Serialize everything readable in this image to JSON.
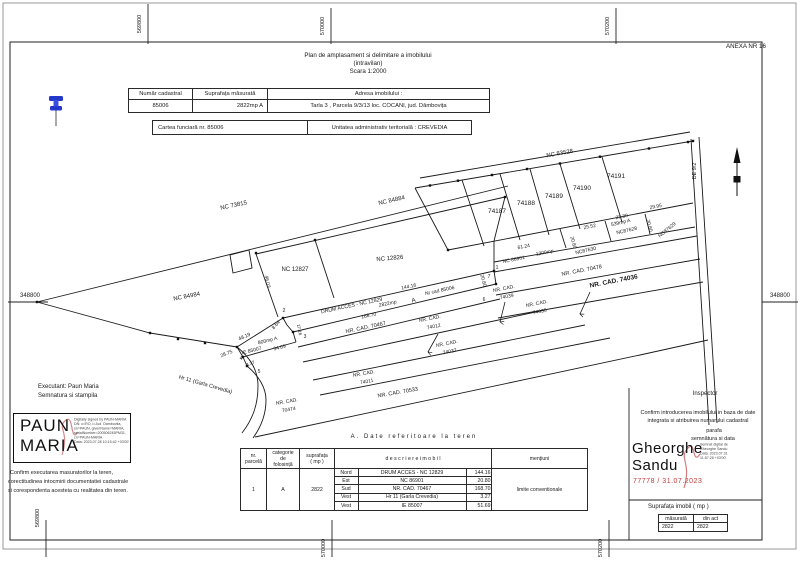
{
  "anexa": "ANEXA NR 16",
  "title": {
    "line1": "Plan de amplasament si delimitare a imobilului",
    "line2": "(intravilan)",
    "line3": "Scara 1:2000"
  },
  "id_table": {
    "h1": "Număr cadastral",
    "h2": "Suprafața măsurată",
    "h3": "Adresa imobilului :",
    "v1": "85006",
    "v2": "2822mp A",
    "v3": "Tarla 3 , Parcela 9/3/13 loc. COCANI, jud. Dâmbovița"
  },
  "cf_row": {
    "left": "Cartea funciară  nr.  85006",
    "right": "Unitatea administrativ teritorială :    CREVEDIA"
  },
  "terrain_table": {
    "title": "A. Date referitoare la teren",
    "headers": {
      "nr_l1": "nr.",
      "nr_l2": "parcelă",
      "cat_l1": "categorie",
      "cat_l2": "de",
      "cat_l3": "folosință",
      "sup_l1": "suprafața",
      "sup_l2": "( mp )",
      "desc": "d e s c r i e r e   i m o b i l",
      "ment": "mențiuni"
    },
    "row": {
      "nr": "1",
      "cat": "A",
      "sup": "2822",
      "ment": "limite conventionale"
    },
    "sides": [
      {
        "dir": "Nord",
        "desc": "DRUM ACCES - NC 12829",
        "len": "144.16"
      },
      {
        "dir": "Est",
        "desc": "NC 86901",
        "len": "20.80"
      },
      {
        "dir": "Sud",
        "desc": "NR. CAD. 70467",
        "len": "168.70"
      },
      {
        "dir": "Vest",
        "desc": "Hr 11 (Garla Crevedia)",
        "len": "3.27"
      },
      {
        "dir": "Vest",
        "desc": "IE 85007",
        "len": "51.69"
      }
    ]
  },
  "executant": {
    "line1": "Executant: Paun Maria",
    "line2": "Semnatura si stampila",
    "stamp_l1": "PAUN",
    "stamp_l2": "MARIA",
    "digital": [
      "Digitally signed by PAUN-MARIA",
      "DN: c=RO, l=Jud. Dambovita,",
      "sn=PAUN, givenName=MARIA,",
      "serialNumber=200506245PM31,",
      "cn=PAUN-MARIA",
      "Data: 2023.07.28 10:15:42 +03'00'"
    ],
    "confirm1": "Confirm executarea masuratorilor la teren,",
    "confirm2": "corectitudinea intocmirii documentatiei cadastrale",
    "confirm3": "si corespondenta acesteia cu realitatea din teren."
  },
  "inspector": {
    "title": "Inspector",
    "confirm1": "Confirm introducerea imobilului in baza de date",
    "confirm2": "integrata si atribuirea numarului cadastral",
    "parafa": "parafa",
    "semnatura": "semnătura si data",
    "name_l1": "Gheorghe",
    "name_l2": "Sandu",
    "digital": [
      "Semnat digital de",
      "Gheorghe Sandu",
      "Data: 2023.07.31",
      "11:57:28 +03'00'"
    ],
    "stamp_red": "77778 / 31.07.2023",
    "red_color": "#c43b3b"
  },
  "area_table": {
    "title": "Suprafața imobil ( mp )",
    "col1": "măsurată",
    "col2": "din act",
    "val1": "2822",
    "val2": "2822"
  },
  "plan": {
    "accent_blue": "#2438cc",
    "labels": [
      {
        "name": "coord-top-569800",
        "text": "569800",
        "x": 141,
        "y": 24,
        "r": -90,
        "s": 5.5
      },
      {
        "name": "coord-top-570000",
        "text": "570000",
        "x": 324,
        "y": 26,
        "r": -90,
        "s": 5.5
      },
      {
        "name": "coord-top-570200",
        "text": "570200",
        "x": 609,
        "y": 26,
        "r": -90,
        "s": 5.5
      },
      {
        "name": "coord-bottom-569800",
        "text": "569800",
        "x": 39,
        "y": 518,
        "r": -90,
        "s": 5.5
      },
      {
        "name": "coord-bottom-570000",
        "text": "570000",
        "x": 325,
        "y": 548,
        "r": -90,
        "s": 5.5
      },
      {
        "name": "coord-bottom-570200",
        "text": "570200",
        "x": 602,
        "y": 548,
        "r": -90,
        "s": 5.5
      },
      {
        "name": "coord-left-348800",
        "text": "348800",
        "x": 30,
        "y": 297,
        "r": 0,
        "s": 6
      },
      {
        "name": "coord-right-348800",
        "text": "348800",
        "x": 780,
        "y": 297,
        "r": 0,
        "s": 6
      },
      {
        "name": "label-nc-73815",
        "text": "NC 73815",
        "x": 234,
        "y": 207,
        "r": -12,
        "s": 6
      },
      {
        "name": "label-nc-84884",
        "text": "NC 84884",
        "x": 392,
        "y": 202,
        "r": -13,
        "s": 6
      },
      {
        "name": "label-nc-84984",
        "text": "NC 84984",
        "x": 187,
        "y": 298,
        "r": -11,
        "s": 6
      },
      {
        "name": "label-nc-12827",
        "text": "NC 12827",
        "x": 295,
        "y": 271,
        "r": 0,
        "s": 6
      },
      {
        "name": "label-nc-12826",
        "text": "NC 12826",
        "x": 390,
        "y": 260,
        "r": -5,
        "s": 6
      },
      {
        "name": "meas-46-03",
        "text": "46.03",
        "x": 266,
        "y": 282,
        "r": 78,
        "s": 5
      },
      {
        "name": "label-nc-83528",
        "text": "NC 83528",
        "x": 560,
        "y": 155,
        "r": -10,
        "s": 6
      },
      {
        "name": "parcel-74187",
        "text": "74187",
        "x": 497,
        "y": 213,
        "r": 0,
        "s": 6.5
      },
      {
        "name": "parcel-74188",
        "text": "74188",
        "x": 526,
        "y": 205,
        "r": 0,
        "s": 6.5
      },
      {
        "name": "parcel-74189",
        "text": "74189",
        "x": 554,
        "y": 198,
        "r": 0,
        "s": 6.5
      },
      {
        "name": "parcel-74190",
        "text": "74190",
        "x": 582,
        "y": 190,
        "r": 0,
        "s": 6.5
      },
      {
        "name": "parcel-74191",
        "text": "74191",
        "x": 616,
        "y": 178,
        "r": 0,
        "s": 6.5
      },
      {
        "name": "label-de-9-2",
        "text": "DE 9/2",
        "x": 696,
        "y": 171,
        "r": -90,
        "s": 5.5
      },
      {
        "name": "meas-25-52",
        "text": "25.52",
        "x": 590,
        "y": 228,
        "r": -11,
        "s": 5
      },
      {
        "name": "meas-27-30",
        "text": "27.30",
        "x": 622,
        "y": 218,
        "r": -11,
        "s": 5
      },
      {
        "name": "meas-29-95",
        "text": "29.95",
        "x": 656,
        "y": 208,
        "r": -11,
        "s": 5
      },
      {
        "name": "label-539mp-a",
        "text": "539mp A",
        "x": 621,
        "y": 224,
        "r": -13,
        "s": 5
      },
      {
        "name": "label-nc87628",
        "text": "NC87628",
        "x": 627,
        "y": 232,
        "r": -13,
        "s": 5
      },
      {
        "name": "label-nc87630",
        "text": "NC87630",
        "x": 586,
        "y": 252,
        "r": -13,
        "s": 5
      },
      {
        "name": "label-nc87629",
        "text": "NC87629",
        "x": 668,
        "y": 231,
        "r": -40,
        "s": 5
      },
      {
        "name": "meas-20-80-a",
        "text": "20.80",
        "x": 572,
        "y": 243,
        "r": 75,
        "s": 5
      },
      {
        "name": "meas-20-80-b",
        "text": "20.80",
        "x": 648,
        "y": 226,
        "r": 75,
        "s": 5
      },
      {
        "name": "meas-20-80-c",
        "text": "20.80",
        "x": 482,
        "y": 281,
        "r": 75,
        "s": 5
      },
      {
        "name": "meas-61-24",
        "text": "61.24",
        "x": 524,
        "y": 248,
        "r": -11,
        "s": 5
      },
      {
        "name": "label-nc-86901",
        "text": "NC 86901",
        "x": 514,
        "y": 261,
        "r": -11,
        "s": 5
      },
      {
        "name": "label-1200mp",
        "text": "1200mp",
        "x": 545,
        "y": 254,
        "r": -11,
        "s": 5
      },
      {
        "name": "point-1",
        "text": "1",
        "x": 497,
        "y": 269,
        "r": 0,
        "s": 5
      },
      {
        "name": "point-7",
        "text": "7",
        "x": 489,
        "y": 278,
        "r": 0,
        "s": 5
      },
      {
        "name": "point-6",
        "text": "6",
        "x": 484,
        "y": 301,
        "r": 0,
        "s": 5
      },
      {
        "name": "label-drum-acces",
        "text": "DRUM ACCES - NC 12829",
        "x": 352,
        "y": 307,
        "r": -12,
        "s": 5.2
      },
      {
        "name": "meas-144-16",
        "text": "144.16",
        "x": 409,
        "y": 288,
        "r": -12,
        "s": 5
      },
      {
        "name": "meas-2822mp",
        "text": "2822mp",
        "x": 388,
        "y": 305,
        "r": -12,
        "s": 5
      },
      {
        "name": "label-a",
        "text": "A",
        "x": 414,
        "y": 302,
        "r": -12,
        "s": 6
      },
      {
        "name": "label-nr-cad-85006",
        "text": "Nr cad 85006",
        "x": 440,
        "y": 292,
        "r": -12,
        "s": 5
      },
      {
        "name": "label-nrcad-70478",
        "text": "NR. CAD. 70478",
        "x": 582,
        "y": 272,
        "r": -11,
        "s": 5.5
      },
      {
        "name": "label-nrcad-74036",
        "text": "NR. CAD. 74036",
        "x": 614,
        "y": 283,
        "r": -11,
        "s": 6.5,
        "w": 600
      },
      {
        "name": "label-nrcad-74039-l1",
        "text": "NR. CAD.",
        "x": 504,
        "y": 290,
        "r": -11,
        "s": 5
      },
      {
        "name": "label-nrcad-74039-l2",
        "text": "74039",
        "x": 507,
        "y": 298,
        "r": -11,
        "s": 5
      },
      {
        "name": "label-nrcad-74035-l1",
        "text": "NR. CAD.",
        "x": 537,
        "y": 305,
        "r": -11,
        "s": 5
      },
      {
        "name": "label-nrcad-74035-l2",
        "text": "74035",
        "x": 540,
        "y": 313,
        "r": -11,
        "s": 5
      },
      {
        "name": "meas-168-70",
        "text": "168.70",
        "x": 369,
        "y": 317,
        "r": -12,
        "s": 5
      },
      {
        "name": "label-nrcad-70467",
        "text": "NR. CAD. 70467",
        "x": 366,
        "y": 329,
        "r": -12,
        "s": 5.5
      },
      {
        "name": "label-nrcad-74012-l1",
        "text": "NR. CAD.",
        "x": 430,
        "y": 320,
        "r": -11,
        "s": 5
      },
      {
        "name": "label-nrcad-74012-l2",
        "text": "74012",
        "x": 434,
        "y": 328,
        "r": -11,
        "s": 5
      },
      {
        "name": "label-nrcad-74037-l1",
        "text": "NR. CAD.",
        "x": 447,
        "y": 345,
        "r": -11,
        "s": 5
      },
      {
        "name": "label-nrcad-74037-l2",
        "text": "74037",
        "x": 450,
        "y": 353,
        "r": -11,
        "s": 5
      },
      {
        "name": "label-nrcad-74011-l1",
        "text": "NR. CAD.",
        "x": 364,
        "y": 375,
        "r": -10,
        "s": 5
      },
      {
        "name": "label-nrcad-74011-l2",
        "text": "74011",
        "x": 367,
        "y": 383,
        "r": -10,
        "s": 5
      },
      {
        "name": "label-nrcad-70533",
        "text": "NR. CAD. 70533",
        "x": 398,
        "y": 394,
        "r": -10,
        "s": 5.5
      },
      {
        "name": "label-nrcad-70474-l1",
        "text": "NR. CAD.",
        "x": 287,
        "y": 403,
        "r": -10,
        "s": 5
      },
      {
        "name": "label-nrcad-70474-l2",
        "text": "70474",
        "x": 289,
        "y": 411,
        "r": -10,
        "s": 5
      },
      {
        "name": "point-2",
        "text": "2",
        "x": 284,
        "y": 312,
        "r": 0,
        "s": 5
      },
      {
        "name": "meas-8-64",
        "text": "8.64",
        "x": 277,
        "y": 326,
        "r": -48,
        "s": 5
      },
      {
        "name": "meas-17-16",
        "text": "17.16",
        "x": 298,
        "y": 330,
        "r": 78,
        "s": 4.5
      },
      {
        "name": "point-3",
        "text": "3",
        "x": 305,
        "y": 338,
        "r": 0,
        "s": 5
      },
      {
        "name": "meas-48-19",
        "text": "48.19",
        "x": 245,
        "y": 338,
        "r": -24,
        "s": 5
      },
      {
        "name": "label-800mp-a",
        "text": "800mp A",
        "x": 268,
        "y": 342,
        "r": -14,
        "s": 5
      },
      {
        "name": "label-ie-85007",
        "text": "IE 85007",
        "x": 252,
        "y": 352,
        "r": -14,
        "s": 5
      },
      {
        "name": "meas-34-09",
        "text": "34.09",
        "x": 280,
        "y": 349,
        "r": -14,
        "s": 5
      },
      {
        "name": "meas-28-75",
        "text": "28.75",
        "x": 227,
        "y": 355,
        "r": -22,
        "s": 5
      },
      {
        "name": "point-4",
        "text": "4",
        "x": 241,
        "y": 360,
        "r": 0,
        "s": 5
      },
      {
        "name": "meas-3-27",
        "text": "3.27",
        "x": 251,
        "y": 365,
        "r": -22,
        "s": 4.5
      },
      {
        "name": "point-5",
        "text": "5",
        "x": 259,
        "y": 373,
        "r": 0,
        "s": 5
      },
      {
        "name": "label-hr-11",
        "text": "Hr 11 (Garla Crevedia)",
        "x": 205,
        "y": 386,
        "r": 16,
        "s": 5.5
      }
    ]
  }
}
